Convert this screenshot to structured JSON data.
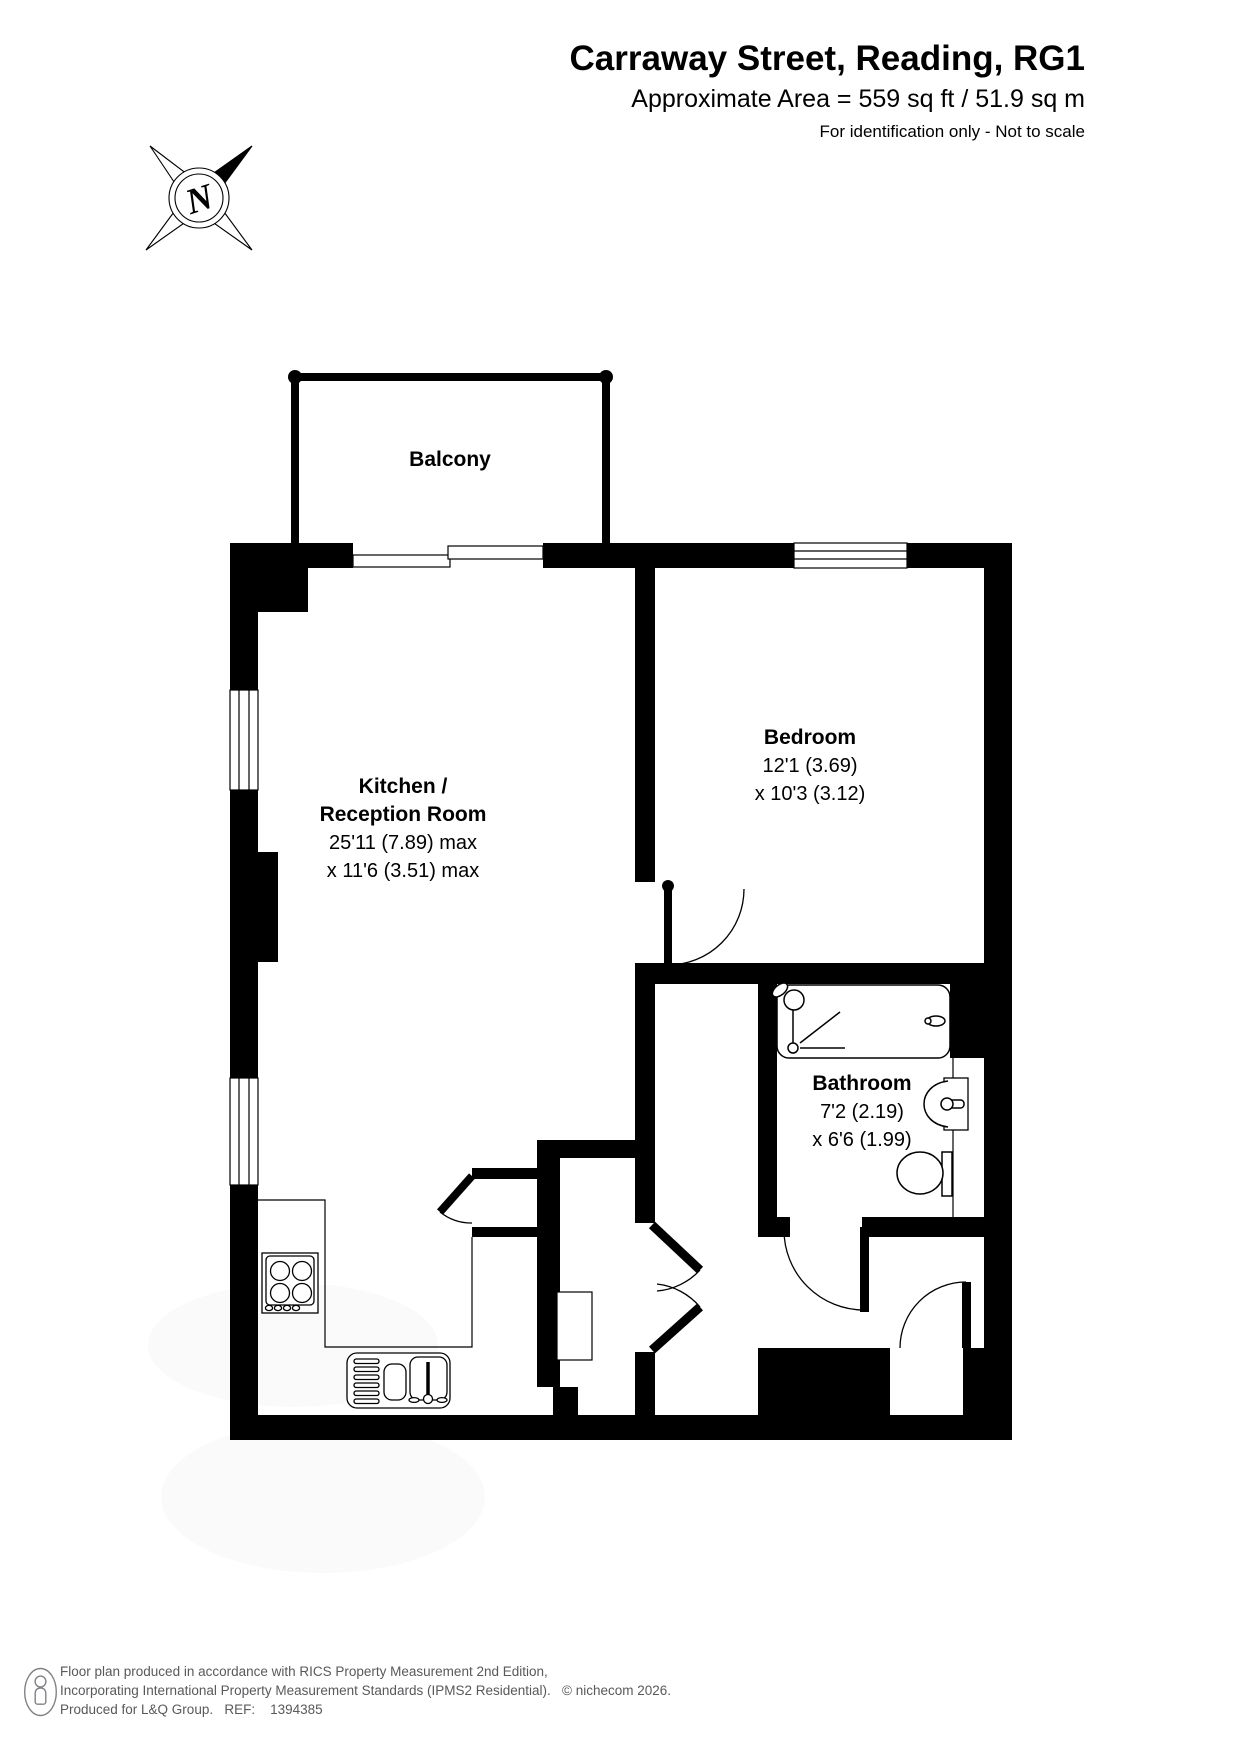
{
  "header": {
    "title": "Carraway Street, Reading, RG1",
    "subtitle": "Approximate Area = 559 sq ft / 51.9 sq m",
    "note": "For identification only - Not to scale"
  },
  "compass": {
    "north_label": "N"
  },
  "rooms": {
    "balcony": {
      "name": "Balcony"
    },
    "kitchen": {
      "name_line1": "Kitchen /",
      "name_line2": "Reception Room",
      "dim_line1": "25'11 (7.89) max",
      "dim_line2": "x 11'6 (3.51) max"
    },
    "bedroom": {
      "name": "Bedroom",
      "dim_line1": "12'1 (3.69)",
      "dim_line2": "x 10'3 (3.12)"
    },
    "bathroom": {
      "name": "Bathroom",
      "dim_line1": "7'2 (2.19)",
      "dim_line2": "x 6'6 (1.99)"
    }
  },
  "footer": {
    "line1": "Floor plan produced in accordance with RICS Property Measurement 2nd Edition,",
    "line2": "Incorporating International Property Measurement Standards (IPMS2 Residential).   © nichecom 2026.",
    "line3": "Produced for L&Q Group.   REF:    1394385"
  },
  "colors": {
    "wall": "#000000",
    "footer_text": "#58595b",
    "watermark": "#fafafa"
  }
}
